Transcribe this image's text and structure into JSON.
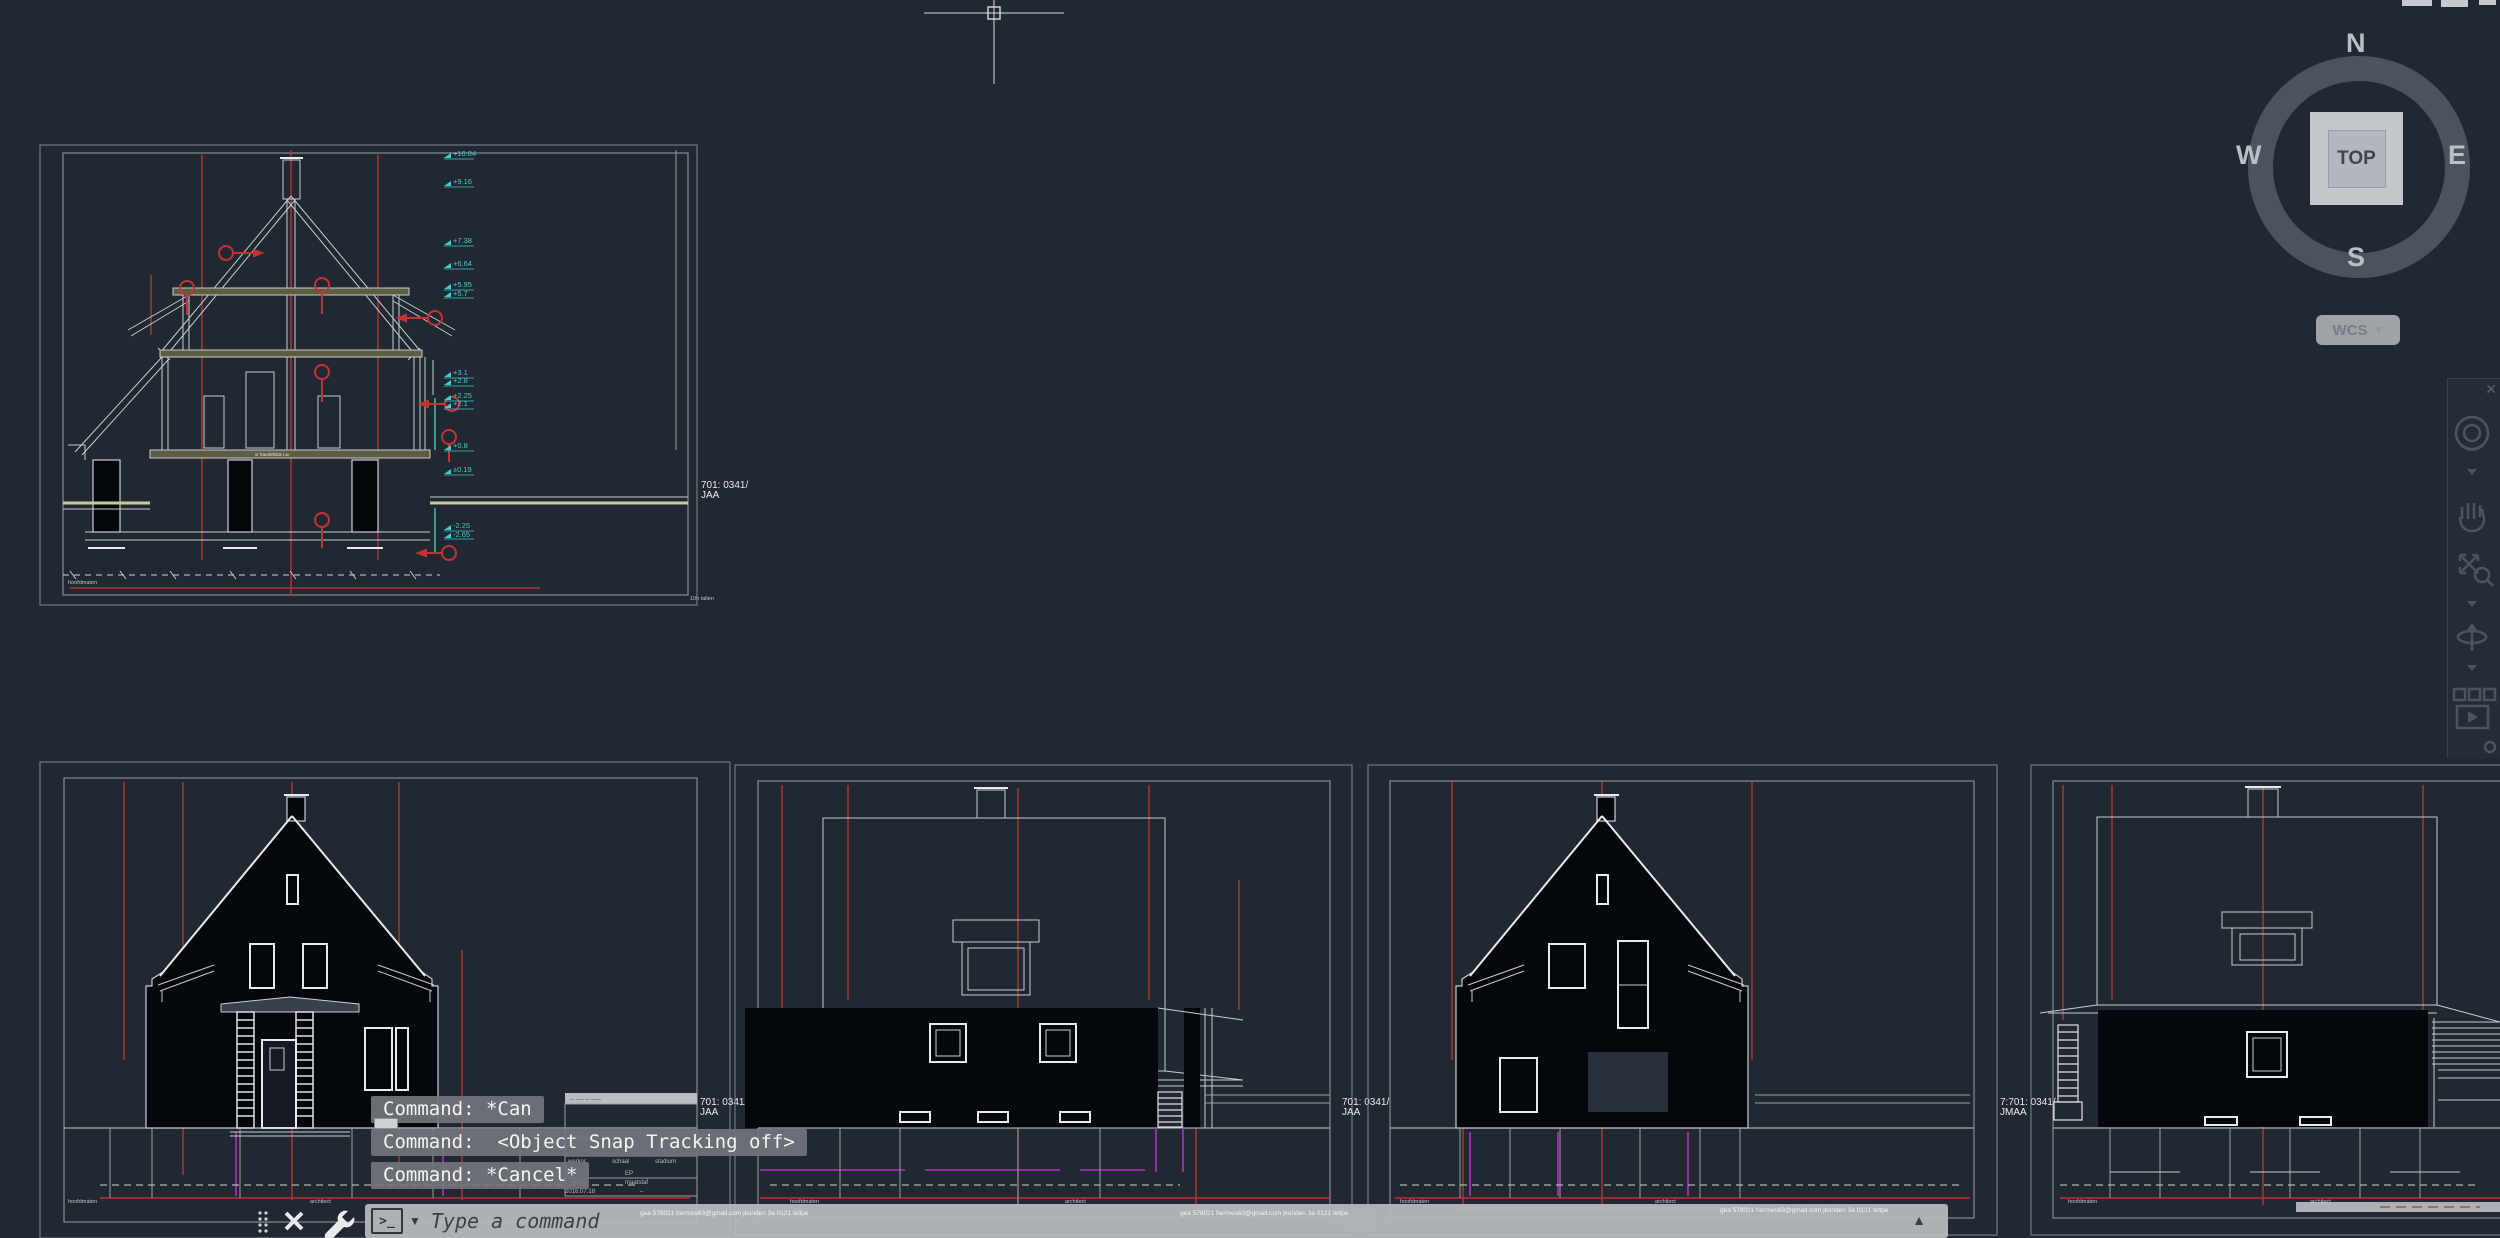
{
  "app": {
    "bg": "#222831"
  },
  "viewcube": {
    "north": "N",
    "west": "W",
    "east": "E",
    "south": "S",
    "top_face": "TOP",
    "wcs_label": "WCS"
  },
  "navbar_icons": [
    "navigation-wheel",
    "pan-hand",
    "zoom-extents",
    "orbit",
    "showmotion"
  ],
  "command": {
    "history": [
      {
        "text": "Command: *Can"
      },
      {
        "text": "Command:  <Object Snap Tracking off>"
      },
      {
        "text": "Command: *Cancel*"
      }
    ],
    "placeholder": "Type a command",
    "prompt_icon": ">_"
  },
  "sheet_labels": {
    "section_l1": "701: 0341/",
    "section_l2": "JAA",
    "vp1_l1": "701: 0341/",
    "vp1_l2": "JAA",
    "vp2_l1": "701: 0341/",
    "vp2_l2": "JAA",
    "vp3_l1": "7:701: 0341/",
    "vp3_l2": "JMAA",
    "note": "10h tallen"
  },
  "section": {
    "marks": [
      {
        "v": "+10.04"
      },
      {
        "v": "+9.16"
      },
      {
        "v": "+7.38"
      },
      {
        "v": "+6.64"
      },
      {
        "v": "+5.95"
      },
      {
        "v": "+5.7"
      },
      {
        "v": "+3.1"
      },
      {
        "v": "+2.8"
      },
      {
        "v": "+2.25"
      },
      {
        "v": "+2.1"
      },
      {
        "v": "+0.8"
      },
      {
        "v": "±0.19"
      },
      {
        "v": "-2.25"
      },
      {
        "v": "-2.65"
      }
    ],
    "slab_note": "vr handelblok t.w.",
    "footer": "hoofdmaten"
  },
  "title_block": {
    "band": "-- ----  --  -----",
    "name": "KELDERPLAN",
    "scale": "1:50",
    "f1": "werknr.",
    "f2": "schaal",
    "f3": "stadium",
    "v1": "101-18",
    "v2": "EP",
    "f4": "koper",
    "f5": "maatstaf",
    "date": "2016.07.18",
    "dash": "–"
  },
  "tiny": {
    "left": "hoofdmaten",
    "mid": "architect",
    "watermark": "gea 578021 hermes63@gmail.com jkunden 3a 0121 tellpe"
  }
}
